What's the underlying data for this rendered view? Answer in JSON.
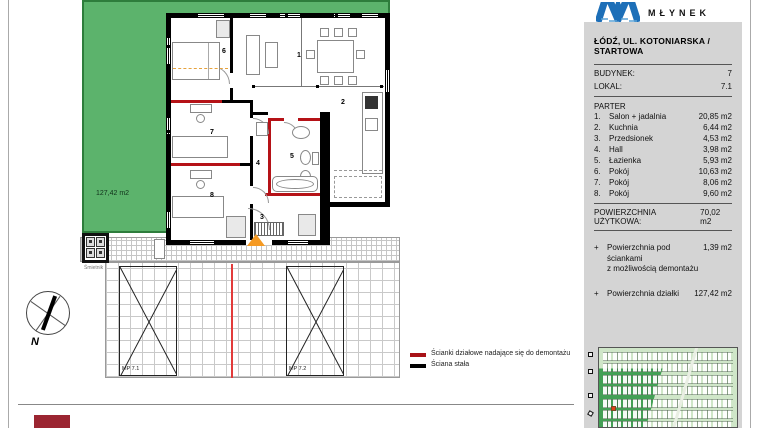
{
  "branding": {
    "logo_text": "MŁYNEK",
    "logo_color": "#1d6fb8"
  },
  "address_bar": {
    "text": "ŁÓDŹ, UL. KOTONIARSKA / STARTOWA"
  },
  "unit_info": {
    "building_label": "BUDYNEK:",
    "building_value": "7",
    "unit_label": "LOKAL:",
    "unit_value": "7.1",
    "floor_label": "PARTER"
  },
  "rooms": [
    {
      "no": "1.",
      "name": "Salon + jadalnia",
      "area": "20,85 m2"
    },
    {
      "no": "2.",
      "name": "Kuchnia",
      "area": "6,44 m2"
    },
    {
      "no": "3.",
      "name": "Przedsionek",
      "area": "4,53 m2"
    },
    {
      "no": "4.",
      "name": "Hall",
      "area": "3,98 m2"
    },
    {
      "no": "5.",
      "name": "Łazienka",
      "area": "5,93 m2"
    },
    {
      "no": "6.",
      "name": "Pokój",
      "area": "10,63 m2"
    },
    {
      "no": "7.",
      "name": "Pokój",
      "area": "8,06 m2"
    },
    {
      "no": "8.",
      "name": "Pokój",
      "area": "9,60 m2"
    }
  ],
  "totals": {
    "usable_label": "POWIERZCHNIA UŻYTKOWA:",
    "usable_value": "70,02 m2"
  },
  "extras": [
    {
      "plus": "+",
      "line1": "Powierzchnia pod ściankami",
      "line2": "z możliwością demontażu",
      "value": "1,39 m2"
    },
    {
      "plus": "+",
      "line1": "Powierzchnia działki",
      "line2": "",
      "value": "127,42 m2"
    }
  ],
  "legend": {
    "demountable_label": "Ścianki działowe nadające się do demontażu",
    "solid_label": "Ściana stała",
    "demountable_color": "#a81217",
    "solid_color": "#000000"
  },
  "plan": {
    "garden_area_label": "127,42 m2",
    "room_numbers": [
      "1",
      "2",
      "3",
      "4",
      "5",
      "6",
      "7",
      "8"
    ],
    "parking_labels": [
      "MP 7.1",
      "MP 7.2"
    ],
    "trash_label": "Śmietnik",
    "compass_label": "N"
  },
  "colors": {
    "garden_green": "#5cb36c",
    "garden_edge": "#2e7d3c",
    "wall_black": "#000000",
    "partition_red": "#b51217",
    "entrance_orange": "#f59a23",
    "panel_gray": "#d4d4d4",
    "map_light_green": "#cfe6c8",
    "map_dark_green": "#43a055",
    "map_red_house": "#e0401a",
    "footer_maroon": "#9b2531"
  }
}
